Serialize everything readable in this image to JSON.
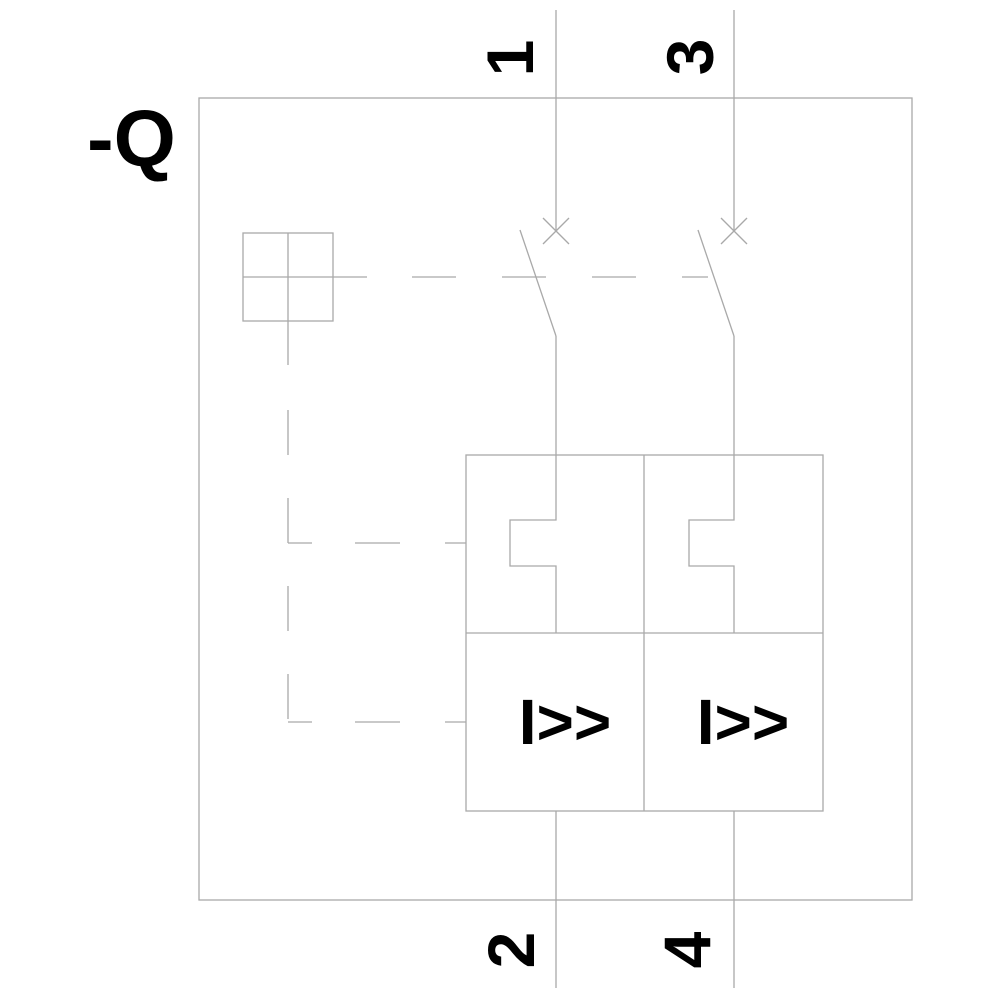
{
  "diagram": {
    "device_label": "-Q",
    "terminals": {
      "top_left": "1",
      "top_right": "3",
      "bottom_left": "2",
      "bottom_right": "4"
    },
    "trip_units": [
      {
        "label": "I>>"
      },
      {
        "label": "I>>"
      }
    ],
    "colors": {
      "line": "#a9a9a9",
      "text": "#000000",
      "background": "#ffffff"
    }
  }
}
